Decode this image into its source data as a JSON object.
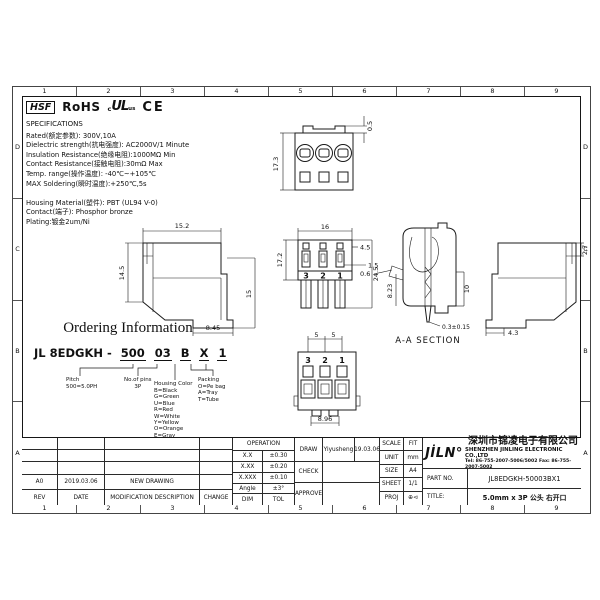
{
  "sheet": {
    "zone_cols": [
      "1",
      "2",
      "3",
      "4",
      "5",
      "6",
      "7",
      "8",
      "9"
    ],
    "zone_rows": [
      "D",
      "C",
      "B",
      "A"
    ]
  },
  "logos": {
    "hsf": "HSF",
    "rohs": "RoHS",
    "ul_c": "c",
    "ul": "UL",
    "ul_us": "us",
    "ce": "CE"
  },
  "specifications": {
    "lines": [
      "SPECIFICATIONS",
      "Rated(额定参数): 300V,10A",
      "Dielectric strength(抗电强度): AC2000V/1 Minute",
      "Insulation Resistance(绝缘电阻):1000MΩ Min",
      "Contact Resistance(接触电阻):30mΩ Max",
      "Temp. range(操作温度): -40℃~+105℃",
      "MAX Soldering(瞬时温度):+250℃,5s",
      "",
      "Housing Material(塑件): PBT (UL94 V-0)",
      "Contact(端子): Phosphor bronze",
      "Plating:镀金2um/Ni"
    ]
  },
  "ordering": {
    "title": "Ordering Information",
    "prefix": "JL 8EDGKH -",
    "segments": [
      "500",
      "03",
      "B",
      "X",
      "1"
    ],
    "groups": [
      {
        "title": "Pitch",
        "lines": [
          "500=5.0PH"
        ]
      },
      {
        "title": "No.of pins",
        "lines": [
          "3P"
        ]
      },
      {
        "title": "Housing Color",
        "lines": [
          "B=Black",
          "G=Green",
          "U=Blue",
          "R=Red",
          "W=White",
          "Y=Yellow",
          "O=Orange",
          "E=Gray"
        ]
      },
      {
        "title": "Packing",
        "lines": [
          "O=Pe bag",
          "A=Tray",
          "T=Tube"
        ]
      }
    ]
  },
  "views": {
    "front_top": {
      "height": "17.3",
      "tab": "0.5"
    },
    "side_left": {
      "width": "15.2",
      "body_height": "14.5",
      "lower_height": "15",
      "foot_width": "8.45"
    },
    "front_main": {
      "width": "16",
      "height": "17.2",
      "slot": "1.5",
      "step": "4.5",
      "total_height": "24.5",
      "pins": [
        "3",
        "2",
        "1"
      ]
    },
    "section": {
      "lip": "0.6",
      "depth": "8.23",
      "pin_len": "10",
      "pin_tip": "0.3±0.15",
      "label": "A-A SECTION"
    },
    "side_right": {
      "top": "2.7",
      "foot": "4.3"
    },
    "bottom_view": {
      "pitch1": "5",
      "pitch2": "5",
      "width": "8.96",
      "pins": [
        "3",
        "2",
        "1"
      ]
    }
  },
  "revision_table": {
    "entry": {
      "rev": "A0",
      "date": "2019.03.06",
      "description": "NEW DRAWING",
      "change": ""
    },
    "headers": {
      "rev": "REV",
      "date": "DATE",
      "description": "MODIFICATION DESCRIPTION",
      "change": "CHANGE"
    }
  },
  "tolerance_table": {
    "title": "OPERATION",
    "rows": [
      {
        "range": "X.X",
        "tol": "±0.30"
      },
      {
        "range": "X.XX",
        "tol": "±0.20"
      },
      {
        "range": "X.XXX",
        "tol": "±0.10"
      },
      {
        "range": "Angle",
        "tol": "±3°"
      }
    ],
    "footer": {
      "range": "DIM",
      "tol": "TOL"
    }
  },
  "sign_table": {
    "draw_label": "DRAW",
    "draw_name": "Yiyusheng",
    "draw_date": "19.03.06",
    "check_label": "CHECK",
    "approve_label": "APPROVE"
  },
  "info_table": {
    "rows": [
      {
        "label": "SCALE",
        "value": "FIT"
      },
      {
        "label": "UNIT",
        "value": "mm"
      },
      {
        "label": "SIZE",
        "value": "A4"
      },
      {
        "label": "SHEET",
        "value": "1/1"
      },
      {
        "label": "PROJ",
        "value": "⊕⊲"
      }
    ]
  },
  "company": {
    "logo": "JİLN°",
    "name_cn": "深圳市锦凌电子有限公司",
    "name_en": "SHENZHEN JINLING ELECTRONIC CO.,LTD",
    "tel": "Tel: 86-755-2007-5006/5002   Fax: 86-755-2007-5002",
    "part_no_label": "PART NO.",
    "part_no": "JL8EDGKH-50003BX1",
    "title_label": "TITLE:",
    "title": "5.0mm x 3P 公头 右开口"
  }
}
